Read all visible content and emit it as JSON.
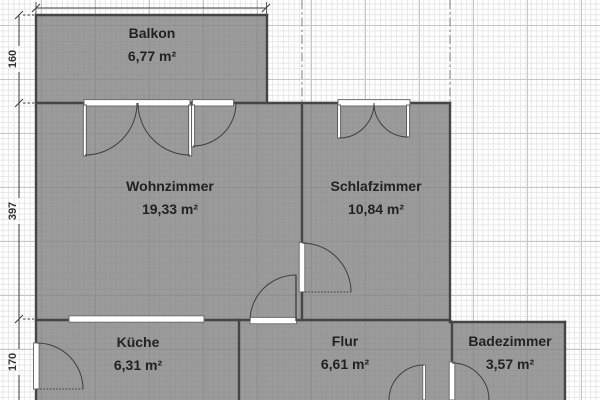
{
  "plan": {
    "title": "apartment floor plan",
    "rooms": [
      {
        "id": "balkon",
        "name": "Balkon",
        "area": "6,77 m²"
      },
      {
        "id": "wohnzimmer",
        "name": "Wohnzimmer",
        "area": "19,33 m²"
      },
      {
        "id": "schlafzimmer",
        "name": "Schlafzimmer",
        "area": "10,84 m²"
      },
      {
        "id": "kueche",
        "name": "Küche",
        "area": "6,31 m²"
      },
      {
        "id": "flur",
        "name": "Flur",
        "area": "6,61 m²"
      },
      {
        "id": "badezimmer",
        "name": "Badezimmer",
        "area": "3,57 m²"
      }
    ],
    "dimensions": {
      "left": [
        "160",
        "397",
        "170"
      ]
    },
    "colors": {
      "background": "#ffffff",
      "grid_minor": "#e7e7e7",
      "grid_major": "#c7c7c7",
      "room_fill": "#9b9b9b",
      "wall": "#454545"
    }
  }
}
